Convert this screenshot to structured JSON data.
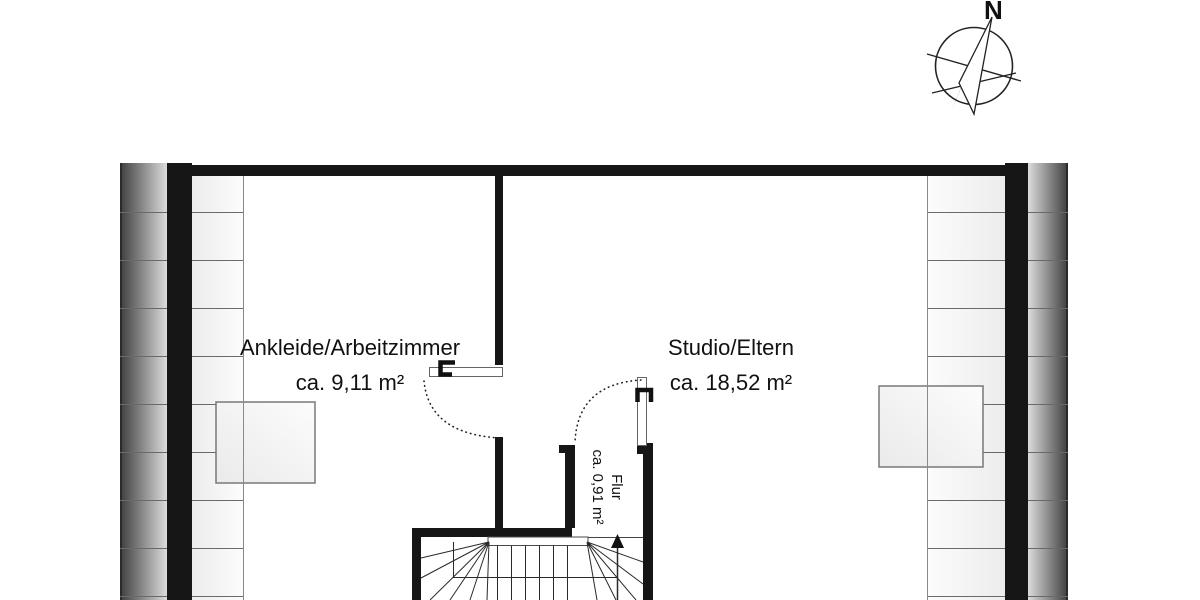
{
  "compass": {
    "label": "N"
  },
  "rooms": [
    {
      "name": "Ankleide/Arbeitzimmer",
      "area": "ca. 9,11 m²"
    },
    {
      "name": "Studio/Eltern",
      "area": "ca. 18,52 m²"
    },
    {
      "name": "Flur",
      "area": "ca. 0,91 m²"
    }
  ],
  "colors": {
    "wall": "#161616",
    "hatch_line": "#6a6a6a",
    "stair_line": "#2a2a2a",
    "text": "#111111",
    "roof_edge_dark": "#3e3e3e",
    "roof_edge_light": "#dcdcdc"
  }
}
